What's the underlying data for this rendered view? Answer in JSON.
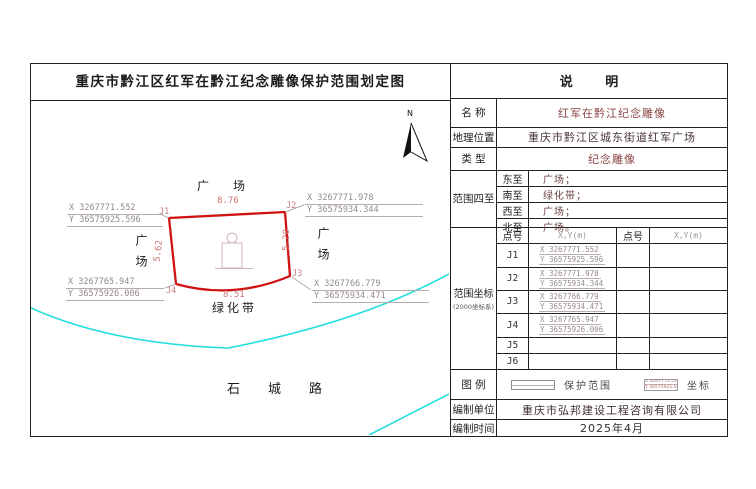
{
  "title": "重庆市黔江区红军在黔江纪念雕像保护范围划定图",
  "north_label": "N",
  "map": {
    "plaza_top": "广场",
    "plaza_left": "广场",
    "plaza_right": "广场",
    "green_belt": "绿化带",
    "road": "石城路",
    "dims": {
      "top": "8.76",
      "bottom": "8.51",
      "left": "5.62",
      "right": "5.20"
    },
    "callouts": [
      {
        "id": "J1",
        "x": "X 3267771.552",
        "y": "Y 36575925.596"
      },
      {
        "id": "J2",
        "x": "X 3267771.978",
        "y": "Y 36575934.344"
      },
      {
        "id": "J3",
        "x": "X 3267766.779",
        "y": "Y 36575934.471"
      },
      {
        "id": "J4",
        "x": "X 3267765.947",
        "y": "Y 36575926.006"
      }
    ]
  },
  "panel": {
    "header": "说 明",
    "name_label": "名 称",
    "name_value": "红军在黔江纪念雕像",
    "location_label": "地理位置",
    "location_value": "重庆市黔江区城东街道红军广场",
    "type_label": "类 型",
    "type_value": "纪念雕像",
    "bounds_label": "范围四至",
    "bounds": [
      {
        "dir": "东至",
        "value": "广场；"
      },
      {
        "dir": "南至",
        "value": "绿化带；"
      },
      {
        "dir": "西至",
        "value": "广场；"
      },
      {
        "dir": "北至",
        "value": "广场。"
      }
    ],
    "coords_label": "范围坐标",
    "coords_sublabel": "(2000坐标系)",
    "coords_header": {
      "point": "点号",
      "xy": "X,Y(m)",
      "point2": "点号",
      "xy2": "X,Y(m)"
    },
    "coords_rows": [
      {
        "id": "J1",
        "x": "X 3267771.552",
        "y": "Y 36575925.596"
      },
      {
        "id": "J2",
        "x": "X 3267771.978",
        "y": "Y 36575934.344"
      },
      {
        "id": "J3",
        "x": "X 3267766.779",
        "y": "Y 36575934.471"
      },
      {
        "id": "J4",
        "x": "X 3267765.947",
        "y": "Y 36575926.006"
      },
      {
        "id": "J5",
        "x": "",
        "y": ""
      },
      {
        "id": "J6",
        "x": "",
        "y": ""
      }
    ],
    "legend_label": "图 例",
    "legend_protection": "保护范围",
    "legend_coord": "坐标",
    "legend_coord_sample_x": "X 3267771.552",
    "legend_coord_sample_y": "Y 36575925.596",
    "unit_label": "编制单位",
    "unit_value": "重庆市弘邦建设工程咨询有限公司",
    "date_label": "编制时间",
    "date_value": "2025年4月"
  },
  "colors": {
    "protection_outline": "#cf1212",
    "road_line": "#25dede",
    "callout_text": "#938989",
    "dimension_text": "#cb7676"
  }
}
